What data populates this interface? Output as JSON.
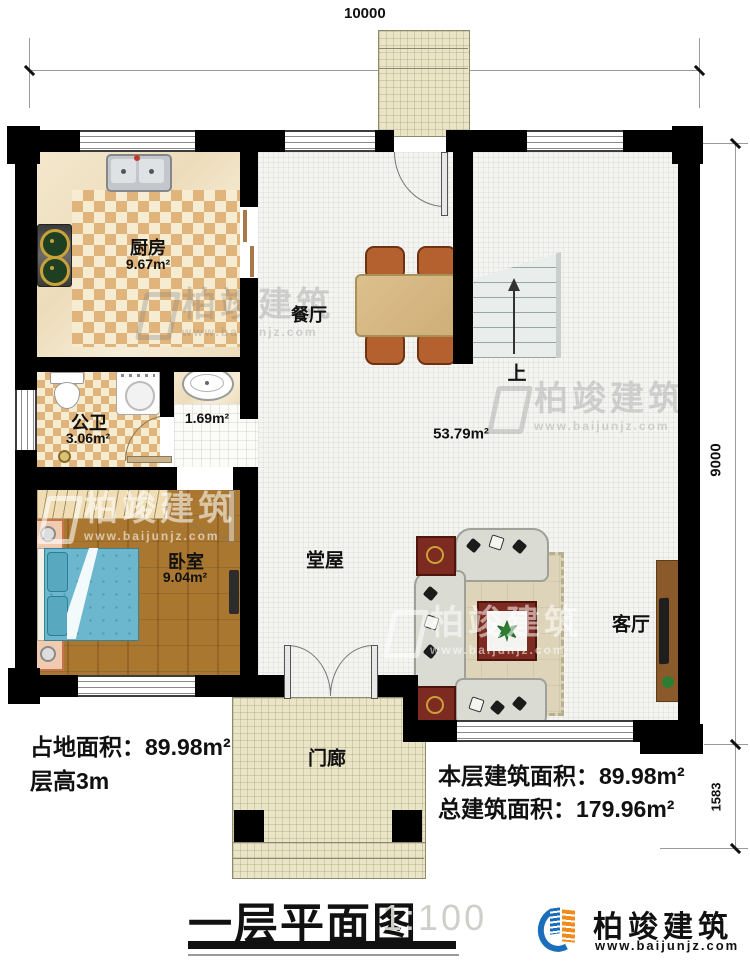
{
  "dimensions": {
    "top": "10000",
    "right_main": "9000",
    "right_porch": "1583"
  },
  "rooms": {
    "kitchen": {
      "name": "厨房",
      "area": "9.67m²"
    },
    "dining": {
      "name": "餐厅"
    },
    "bathroom": {
      "name": "公卫",
      "area": "3.06m²"
    },
    "nook": {
      "area": "1.69m²"
    },
    "bedroom": {
      "name": "卧室",
      "area": "9.04m²"
    },
    "hall": {
      "name": "堂屋",
      "area": "53.79m²"
    },
    "living": {
      "name": "客厅"
    },
    "porch": {
      "name": "门廊"
    },
    "stairs": {
      "direction": "上"
    }
  },
  "notes": {
    "site_area": "占地面积：89.98m²",
    "floor_height": "层高3m",
    "floor_area": "本层建筑面积：89.98m²",
    "total_area": "总建筑面积：179.96m²"
  },
  "titleblock": {
    "title": "一层平面图",
    "scale": "1:100"
  },
  "logo": {
    "brand": "柏竣建筑",
    "url": "www.baijunjz.com",
    "icon": "building-swoosh-icon"
  },
  "watermark": {
    "brand": "柏竣建筑",
    "url": "www.baijunjz.com"
  },
  "colors": {
    "wall": "#000000",
    "tile": "#e0b47a",
    "wood": "#a9772f",
    "logo_blue": "#1b6fba",
    "logo_orange": "#f08c1e"
  }
}
